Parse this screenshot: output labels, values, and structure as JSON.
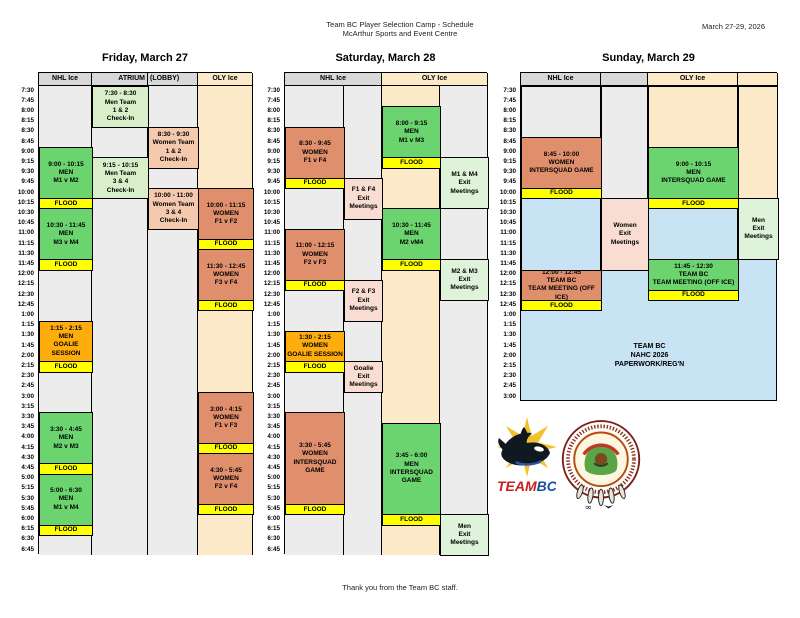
{
  "header": {
    "title_line1": "Team BC Player Selection Camp - Schedule",
    "title_line2": "McArthur Sports and Event Centre",
    "date_range": "March 27-29, 2026"
  },
  "footer": {
    "text": "Thank you from the Team BC staff."
  },
  "logos": {
    "teambc_word_part1": "TEAM",
    "teambc_word_part2": "BC"
  },
  "colors": {
    "green": "#6cd46f",
    "ltgreen": "#d9efca",
    "exitgreen": "#def3d9",
    "salmon": "#e08f6d",
    "pink": "#f4c9ae",
    "exitpink": "#f9ddd2",
    "orange": "#ffad0d",
    "yellow": "#ffff00",
    "cream": "#fce9c8",
    "blue": "#c8e4f4",
    "colGray": "#ececec",
    "hdrGray": "#d8d8d8"
  },
  "layout": {
    "grid_top": 72,
    "header_h": 13,
    "row_h": 10.2,
    "title_y": 52
  },
  "days": [
    {
      "id": "friday",
      "title": "Friday, March 27",
      "rows": 46,
      "layout": {
        "x": 38,
        "cols": [
          53,
          56,
          50,
          55
        ],
        "bg": "#ffffff"
      },
      "header_cells": [
        {
          "label": "NHL Ice",
          "cols": [
            0
          ],
          "bg": "hdrGray",
          "align": "center"
        },
        {
          "label": "ATRIUM",
          "cols": [
            1
          ],
          "bg": "hdrGray",
          "align": "right"
        },
        {
          "label": "(LOBBY)",
          "cols": [
            2
          ],
          "bg": "hdrGray",
          "align": "left"
        },
        {
          "label": "OLY Ice",
          "cols": [
            3
          ],
          "bg": "cream",
          "align": "center"
        }
      ],
      "col_bg": [
        "colGray",
        "colGray",
        "colGray",
        "cream"
      ],
      "segments": [],
      "time_labels": [
        "7:30",
        "7:45",
        "8:00",
        "8:15",
        "8:30",
        "8:45",
        "9:00",
        "9:15",
        "9:30",
        "9:45",
        "10:00",
        "10:15",
        "10:30",
        "10:45",
        "11:00",
        "11:15",
        "11:30",
        "11:45",
        "12:00",
        "12:15",
        "12:30",
        "12:45",
        "1:00",
        "1:15",
        "1:30",
        "1:45",
        "2:00",
        "2:15",
        "2:30",
        "2:45",
        "3:00",
        "3:15",
        "3:30",
        "3:45",
        "4:00",
        "4:15",
        "4:30",
        "4:45",
        "5:00",
        "5:15",
        "5:30",
        "5:45",
        "6:00",
        "6:15",
        "6:30",
        "6:45"
      ],
      "blocks": [
        {
          "col": 1,
          "row": 0,
          "span": 4,
          "bg": "ltgreen",
          "lines": [
            "7:30 - 8:30",
            "Men Team",
            "1 & 2",
            "Check-In"
          ]
        },
        {
          "col": 2,
          "row": 4,
          "span": 4,
          "bg": "pink",
          "lines": [
            "8:30 - 9:30",
            "Women Team",
            "1 & 2",
            "Check-In"
          ]
        },
        {
          "col": 0,
          "row": 6,
          "span": 5,
          "bg": "green",
          "lines": [
            "9:00 - 10:15",
            "MEN",
            "M1 v M2"
          ]
        },
        {
          "col": 1,
          "row": 7,
          "span": 4,
          "bg": "ltgreen",
          "lines": [
            "9:15 - 10:15",
            "Men Team",
            "3 & 4",
            "Check-In"
          ]
        },
        {
          "col": 2,
          "row": 10,
          "span": 4,
          "bg": "pink",
          "lines": [
            "10:00 - 11:00",
            "Women Team",
            "3 & 4",
            "Check-In"
          ]
        },
        {
          "col": 3,
          "row": 10,
          "span": 5,
          "bg": "salmon",
          "lines": [
            "10:00 - 11:15",
            "WOMEN",
            "F1 v F2"
          ]
        },
        {
          "col": 0,
          "row": 11,
          "span": 1,
          "bg": "yellow",
          "lines": [
            "FLOOD"
          ]
        },
        {
          "col": 0,
          "row": 12,
          "span": 5,
          "bg": "green",
          "lines": [
            "10:30 - 11:45",
            "MEN",
            "M3 v M4"
          ]
        },
        {
          "col": 3,
          "row": 15,
          "span": 1,
          "bg": "yellow",
          "lines": [
            "FLOOD"
          ]
        },
        {
          "col": 3,
          "row": 16,
          "span": 5,
          "bg": "salmon",
          "lines": [
            "11:30 - 12:45",
            "WOMEN",
            "F3 v F4"
          ]
        },
        {
          "col": 0,
          "row": 17,
          "span": 1,
          "bg": "yellow",
          "lines": [
            "FLOOD"
          ]
        },
        {
          "col": 3,
          "row": 21,
          "span": 1,
          "bg": "yellow",
          "lines": [
            "FLOOD"
          ]
        },
        {
          "col": 0,
          "row": 23,
          "span": 4,
          "bg": "orange",
          "lines": [
            "1:15 - 2:15",
            "MEN",
            "GOALIE SESSION"
          ]
        },
        {
          "col": 0,
          "row": 27,
          "span": 1,
          "bg": "yellow",
          "lines": [
            "FLOOD"
          ]
        },
        {
          "col": 3,
          "row": 30,
          "span": 5,
          "bg": "salmon",
          "lines": [
            "3:00 - 4:15",
            "WOMEN",
            "F1 v F3"
          ]
        },
        {
          "col": 0,
          "row": 32,
          "span": 5,
          "bg": "green",
          "lines": [
            "3:30 - 4:45",
            "MEN",
            "M2 v M3"
          ]
        },
        {
          "col": 3,
          "row": 35,
          "span": 1,
          "bg": "yellow",
          "lines": [
            "FLOOD"
          ]
        },
        {
          "col": 3,
          "row": 36,
          "span": 5,
          "bg": "salmon",
          "lines": [
            "4:30 - 5:45",
            "WOMEN",
            "F2 v F4"
          ]
        },
        {
          "col": 0,
          "row": 37,
          "span": 1,
          "bg": "yellow",
          "lines": [
            "FLOOD"
          ]
        },
        {
          "col": 0,
          "row": 38,
          "span": 5,
          "bg": "green",
          "lines": [
            "5:00 - 6:30",
            "MEN",
            "M1 v M4"
          ]
        },
        {
          "col": 3,
          "row": 41,
          "span": 1,
          "bg": "yellow",
          "lines": [
            "FLOOD"
          ]
        },
        {
          "col": 0,
          "row": 43,
          "span": 1,
          "bg": "yellow",
          "lines": [
            "FLOOD"
          ]
        }
      ]
    },
    {
      "id": "saturday",
      "title": "Saturday, March 28",
      "rows": 46,
      "layout": {
        "x": 284,
        "cols": [
          59,
          38,
          58,
          48
        ],
        "bg": "#ffffff"
      },
      "header_cells": [
        {
          "label": "NHL Ice",
          "cols": [
            0,
            1
          ],
          "bg": "hdrGray",
          "align": "center"
        },
        {
          "label": "OLY Ice",
          "cols": [
            2,
            3
          ],
          "bg": "cream",
          "align": "center"
        }
      ],
      "col_bg": [
        "colGray",
        "colGray",
        "cream",
        "colGray"
      ],
      "segments": [],
      "time_labels": [
        "7:30",
        "7:45",
        "8:00",
        "8:15",
        "8:30",
        "8:45",
        "9:00",
        "9:15",
        "9:30",
        "9:45",
        "10:00",
        "10:15",
        "10:30",
        "10:45",
        "11:00",
        "11:15",
        "11:30",
        "11:45",
        "12:00",
        "12:15",
        "12:30",
        "12:45",
        "1:00",
        "1:15",
        "1:30",
        "1:45",
        "2:00",
        "2:15",
        "2:30",
        "2:45",
        "3:00",
        "3:15",
        "3:30",
        "3:45",
        "4:00",
        "4:15",
        "4:30",
        "4:45",
        "5:00",
        "5:15",
        "5:30",
        "5:45",
        "6:00",
        "6:15",
        "6:30",
        "6:45"
      ],
      "blocks": [
        {
          "col": 2,
          "row": 2,
          "span": 5,
          "bg": "green",
          "lines": [
            "8:00 - 9:15",
            "MEN",
            "M1 v M3"
          ]
        },
        {
          "col": 0,
          "row": 4,
          "span": 5,
          "bg": "salmon",
          "lines": [
            "8:30 - 9:45",
            "WOMEN",
            "F1 v F4"
          ]
        },
        {
          "col": 2,
          "row": 7,
          "span": 1,
          "bg": "yellow",
          "lines": [
            "FLOOD"
          ]
        },
        {
          "col": 3,
          "row": 7,
          "span": 5,
          "bg": "exitgreen",
          "lines": [
            "M1 & M4",
            "Exit",
            "Meetings"
          ]
        },
        {
          "col": 0,
          "row": 9,
          "span": 1,
          "bg": "yellow",
          "lines": [
            "FLOOD"
          ]
        },
        {
          "col": 1,
          "row": 9,
          "span": 4,
          "bg": "exitpink",
          "lines": [
            "F1 & F4",
            "Exit",
            "Meetings"
          ]
        },
        {
          "col": 2,
          "row": 12,
          "span": 5,
          "bg": "green",
          "lines": [
            "10:30 - 11:45",
            "MEN",
            "M2 vM4"
          ]
        },
        {
          "col": 0,
          "row": 14,
          "span": 5,
          "bg": "salmon",
          "lines": [
            "11:00 - 12:15",
            "WOMEN",
            "F2 v F3"
          ]
        },
        {
          "col": 2,
          "row": 17,
          "span": 1,
          "bg": "yellow",
          "lines": [
            "FLOOD"
          ]
        },
        {
          "col": 3,
          "row": 17,
          "span": 4,
          "bg": "exitgreen",
          "lines": [
            "M2 & M3",
            "Exit",
            "Meetings"
          ]
        },
        {
          "col": 0,
          "row": 19,
          "span": 1,
          "bg": "yellow",
          "lines": [
            "FLOOD"
          ]
        },
        {
          "col": 1,
          "row": 19,
          "span": 4,
          "bg": "exitpink",
          "lines": [
            "F2 & F3",
            "Exit",
            "Meetings"
          ]
        },
        {
          "col": 0,
          "row": 24,
          "span": 3,
          "bg": "orange",
          "lines": [
            "1:30 - 2:15",
            "WOMEN",
            "GOALIE SESSION"
          ]
        },
        {
          "col": 0,
          "row": 27,
          "span": 1,
          "bg": "yellow",
          "lines": [
            "FLOOD"
          ]
        },
        {
          "col": 1,
          "row": 27,
          "span": 3,
          "bg": "exitpink",
          "lines": [
            "Goalie",
            "Exit",
            "Meetings"
          ]
        },
        {
          "col": 0,
          "row": 32,
          "span": 9,
          "bg": "salmon",
          "lines": [
            "3:30 - 5:45",
            "WOMEN",
            "INTERSQUAD",
            "GAME"
          ]
        },
        {
          "col": 2,
          "row": 33,
          "span": 9,
          "bg": "green",
          "lines": [
            "3:45 - 6:00",
            "MEN",
            "INTERSQUAD",
            "GAME"
          ]
        },
        {
          "col": 0,
          "row": 41,
          "span": 1,
          "bg": "yellow",
          "lines": [
            "FLOOD"
          ]
        },
        {
          "col": 2,
          "row": 42,
          "span": 1,
          "bg": "yellow",
          "lines": [
            "FLOOD"
          ]
        },
        {
          "col": 3,
          "row": 42,
          "span": 4,
          "bg": "exitgreen",
          "lines": [
            "Men",
            "Exit",
            "Meetings"
          ]
        }
      ]
    },
    {
      "id": "sunday",
      "title": "Sunday, March 29",
      "rows": 31,
      "layout": {
        "x": 520,
        "cols": [
          80,
          47,
          90,
          40
        ],
        "bg": "#c8e4f4",
        "no_col_borders": true
      },
      "header_cells": [
        {
          "label": "NHL Ice",
          "cols": [
            0
          ],
          "bg": "hdrGray",
          "align": "center"
        },
        {
          "label": "",
          "cols": [
            1
          ],
          "bg": "hdrGray",
          "align": "center"
        },
        {
          "label": "OLY Ice",
          "cols": [
            2
          ],
          "bg": "cream",
          "align": "center"
        },
        {
          "label": "",
          "cols": [
            3
          ],
          "bg": "cream",
          "align": "center"
        }
      ],
      "col_bg": null,
      "segments": [
        {
          "col": 0,
          "row": 0,
          "span": 5,
          "bg": "colGray"
        },
        {
          "col": 1,
          "row": 0,
          "span": 11,
          "bg": "colGray"
        },
        {
          "col": 2,
          "row": 0,
          "span": 6,
          "bg": "cream"
        },
        {
          "col": 3,
          "row": 0,
          "span": 11,
          "bg": "cream"
        },
        {
          "col": 0,
          "row": 11,
          "span": 7,
          "bg": "blue"
        },
        {
          "col": 2,
          "row": 12,
          "span": 5,
          "bg": "blue"
        }
      ],
      "time_labels": [
        "7:30",
        "7:45",
        "8:00",
        "8:15",
        "8:30",
        "8:45",
        "9:00",
        "9:15",
        "9:30",
        "9:45",
        "10:00",
        "10:15",
        "10:30",
        "10:45",
        "11:00",
        "11:15",
        "11:30",
        "11:45",
        "12:00",
        "12:15",
        "12:30",
        "12:45",
        "1:00",
        "1:15",
        "1:30",
        "1:45",
        "2:00",
        "2:15",
        "2:30",
        "2:45",
        "3:00"
      ],
      "blocks": [
        {
          "col": 0,
          "row": 5,
          "span": 5,
          "bg": "salmon",
          "lines": [
            "8:45 - 10:00",
            "WOMEN",
            "INTERSQUAD GAME"
          ]
        },
        {
          "col": 2,
          "row": 6,
          "span": 5,
          "bg": "green",
          "lines": [
            "9:00 - 10:15",
            "MEN",
            "INTERSQUAD GAME"
          ]
        },
        {
          "col": 0,
          "row": 10,
          "span": 1,
          "bg": "yellow",
          "lines": [
            "FLOOD"
          ]
        },
        {
          "col": 2,
          "row": 11,
          "span": 1,
          "bg": "yellow",
          "lines": [
            "FLOOD"
          ]
        },
        {
          "col": 1,
          "row": 11,
          "span": 7,
          "bg": "exitpink",
          "lines": [
            "Women",
            "Exit",
            "Meetings"
          ]
        },
        {
          "col": 3,
          "row": 11,
          "span": 6,
          "bg": "exitgreen",
          "lines": [
            "Men",
            "Exit",
            "Meetings"
          ]
        },
        {
          "col": 2,
          "row": 17,
          "span": 3,
          "bg": "green",
          "lines": [
            "11:45 - 12:30",
            "TEAM BC",
            "TEAM MEETING (OFF ICE)"
          ]
        },
        {
          "col": 0,
          "row": 18,
          "span": 3,
          "bg": "salmon",
          "lines": [
            "12:00 - 12:45",
            "TEAM BC",
            "TEAM MEETING (OFF ICE)"
          ]
        },
        {
          "col": 2,
          "row": 20,
          "span": 1,
          "bg": "yellow",
          "lines": [
            "FLOOD"
          ]
        },
        {
          "col": 0,
          "row": 21,
          "span": 1,
          "bg": "yellow",
          "lines": [
            "FLOOD"
          ]
        },
        {
          "col_start": 0,
          "col_end": 3,
          "row": 24,
          "span": 5,
          "borderless": true,
          "lines": [
            "TEAM BC",
            "NAHC 2026",
            "PAPERWORK/REG'N"
          ]
        }
      ]
    }
  ]
}
